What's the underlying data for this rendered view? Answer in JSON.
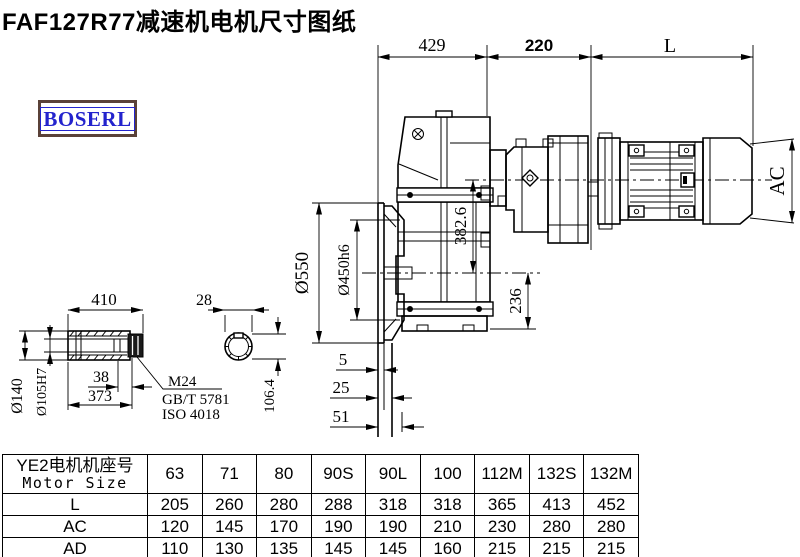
{
  "title": "FAF127R77减速机电机尺寸图纸",
  "logo": "BOSERL",
  "colors": {
    "ink": "#000000",
    "logo_text": "#2323cd",
    "logo_border": "#5a4138"
  },
  "drawing": {
    "dims": {
      "d429": "429",
      "d220": "220",
      "dL": "L",
      "dAC": "AC",
      "d550": "Ø550",
      "d450": "Ø450h6",
      "d382": "382.6",
      "d236": "236",
      "d5": "5",
      "d25": "25",
      "d51": "51"
    },
    "shaft": {
      "d410": "410",
      "d28": "28",
      "d38": "38",
      "d373": "373",
      "d140": "Ø140",
      "d105": "Ø105H7",
      "bolt": "M24",
      "std1": "GB/T 5781",
      "std2": "ISO 4018",
      "d106": "106.4"
    }
  },
  "table": {
    "header_cn": "YE2电机机座号",
    "header_en": "Motor Size",
    "columns": [
      "63",
      "71",
      "80",
      "90S",
      "90L",
      "100",
      "112M",
      "132S",
      "132M"
    ],
    "rows": [
      {
        "label": "L",
        "values": [
          "205",
          "260",
          "280",
          "288",
          "318",
          "318",
          "365",
          "413",
          "452"
        ]
      },
      {
        "label": "AC",
        "values": [
          "120",
          "145",
          "170",
          "190",
          "190",
          "210",
          "230",
          "280",
          "280"
        ]
      },
      {
        "label": "AD",
        "values": [
          "110",
          "130",
          "135",
          "145",
          "145",
          "160",
          "215",
          "215",
          "215"
        ]
      }
    ]
  }
}
